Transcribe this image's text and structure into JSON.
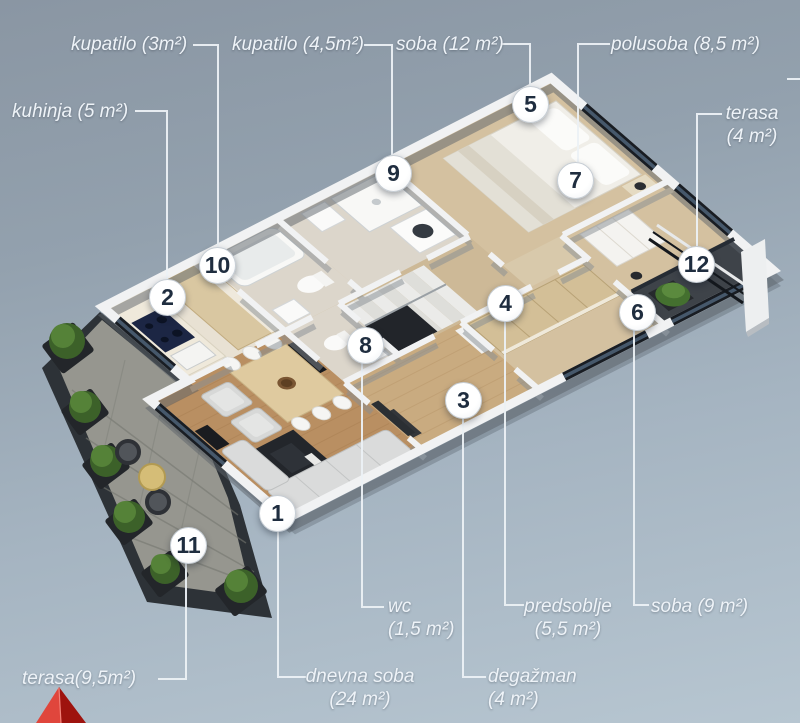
{
  "scene": {
    "type": "3d-isometric-floor-plan",
    "language": "sr",
    "area_unit": "m²"
  },
  "palette": {
    "background_top": "#8a96a3",
    "background_bottom": "#b7c6d1",
    "label_text": "#eef3f8",
    "connector_line": "#ecf1f5",
    "marker_background": "#ffffff",
    "marker_number": "#1f2d3f",
    "wall_white": "#f1f2f3",
    "window_dark": "#191d23",
    "floor_wood_light": "#d4c1a0",
    "floor_living_wood": "#b98f62",
    "floor_bathroom": "#dcd6cb",
    "terrace_dark_rim": "#2d3237",
    "terrace_pavers": "#96968f",
    "plant_green": "#3c6129",
    "logo_red_light": "#e0463c",
    "logo_red_dark": "#9e130e"
  },
  "markers": {
    "m1": "1",
    "m2": "2",
    "m3": "3",
    "m4": "4",
    "m5": "5",
    "m6": "6",
    "m7": "7",
    "m8": "8",
    "m9": "9",
    "m10": "10",
    "m11": "11",
    "m12": "12"
  },
  "labels": {
    "kupatilo3": {
      "text": "kupatilo (3m²)",
      "marker": "10"
    },
    "kupatilo45": {
      "text": "kupatilo (4,5m²)",
      "marker": "9"
    },
    "soba12": {
      "text": "soba (12 m²)",
      "marker": "5"
    },
    "polusoba": {
      "text": "polusoba (8,5 m²)",
      "marker": "7"
    },
    "kuhinja": {
      "text": "kuhinja (5 m²)",
      "marker": "2"
    },
    "terasa4": {
      "line1": "terasa",
      "line2": "(4 m²)",
      "marker": "12"
    },
    "terasa95": {
      "text": "terasa(9,5m²)",
      "marker": "11"
    },
    "dnevna": {
      "line1": "dnevna soba",
      "line2": "(24 m²)",
      "marker": "1"
    },
    "wc": {
      "line1": "wc",
      "line2": "(1,5 m²)",
      "marker": "8"
    },
    "degazman": {
      "line1": "degažman",
      "line2": "(4 m²)",
      "marker": "3"
    },
    "predsoblje": {
      "line1": "predsoblje",
      "line2": "(5,5 m²)",
      "marker": "4"
    },
    "soba9": {
      "text": "soba (9 m²)",
      "marker": "6"
    }
  }
}
